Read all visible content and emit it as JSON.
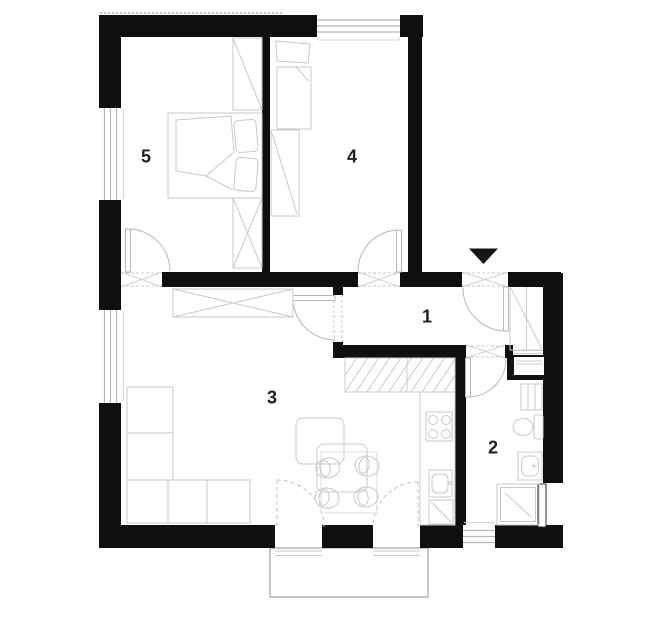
{
  "floor_plan": {
    "rooms": [
      {
        "label": "1",
        "shown_as": "hallway"
      },
      {
        "label": "2",
        "shown_as": "bathroom"
      },
      {
        "label": "3",
        "shown_as": "living-room-with-kitchen"
      },
      {
        "label": "4",
        "shown_as": "bedroom-small"
      },
      {
        "label": "5",
        "shown_as": "bedroom-large"
      }
    ],
    "entrance_marker": "down-arrow",
    "colors": {
      "wall": "#0f0f0f",
      "label": "#1f1f1f",
      "furniture_line": "#c9c9c9",
      "door_line": "#b5b5b5",
      "window_line": "#b8b8b8",
      "balcony_line": "#8f8f8f",
      "background": "#ffffff"
    }
  }
}
